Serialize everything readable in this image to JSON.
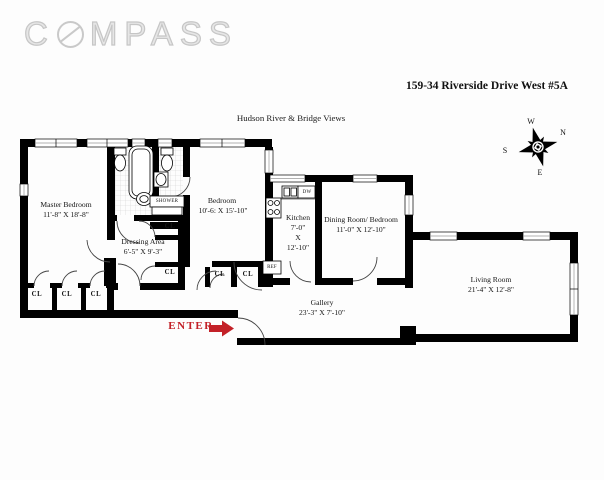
{
  "header": {
    "logo": {
      "part1": "C",
      "part2": "MPASS",
      "full": "COMPASS"
    },
    "address": "159-34 Riverside Drive West #5A",
    "view_note": "Hudson River & Bridge Views"
  },
  "compass_rose": {
    "n": "N",
    "s": "S",
    "e": "E",
    "w": "W"
  },
  "rooms": {
    "master_bedroom": {
      "name": "Master Bedroom",
      "dims": "11'-8\" X 18'-8\""
    },
    "bedroom": {
      "name": "Bedroom",
      "dims": "10'-6: X 15'-10\""
    },
    "dressing_area": {
      "name": "Dressing Area",
      "dims": "6'-5\" X 9'-3\""
    },
    "kitchen": {
      "name": "Kitchen",
      "dims_l1": "7'-0\"",
      "dims_l2": "X",
      "dims_l3": "12'-10\""
    },
    "dining_room": {
      "name": "Dining Room/ Bedroom",
      "dims": "11'-0\" X 12'-10\""
    },
    "living_room": {
      "name": "Living Room",
      "dims": "21'-4\" X 12'-8\""
    },
    "gallery": {
      "name": "Gallery",
      "dims": "23'-3\" X 7'-10\""
    }
  },
  "labels": {
    "closet": "CL",
    "shower": "SHOWER",
    "dishwasher": "DW",
    "refrigerator": "REF",
    "enter": "ENTER"
  },
  "colors": {
    "wall": "#000000",
    "enter_red": "#c32128",
    "logo_gray": "#c9c9c9",
    "tile_gray": "#cccccc"
  }
}
